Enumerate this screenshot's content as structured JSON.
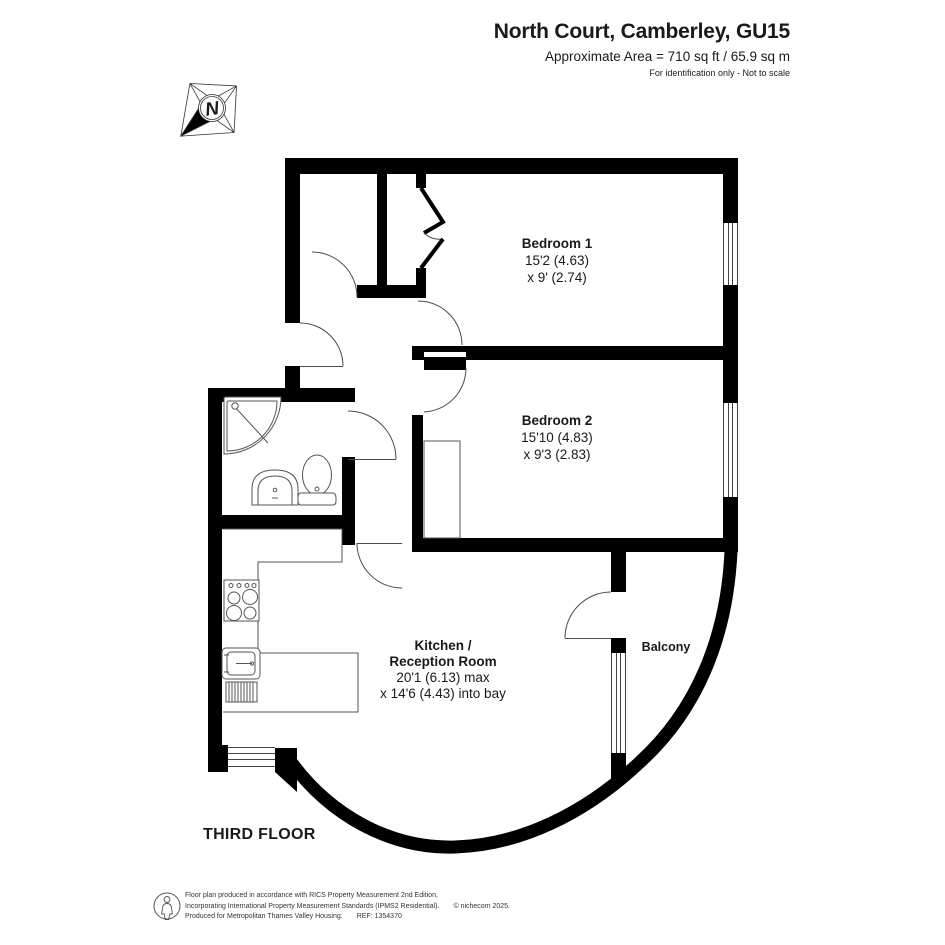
{
  "header": {
    "title": "North Court, Camberley, GU15",
    "area_line": "Approximate Area = 710 sq ft / 65.9 sq m",
    "note": "For identification only - Not to scale"
  },
  "floor_label": "THIRD FLOOR",
  "compass_label": "N",
  "rooms": {
    "bedroom1": {
      "name": "Bedroom 1",
      "dim_line1": "15'2 (4.63)",
      "dim_line2": "x 9' (2.74)"
    },
    "bedroom2": {
      "name": "Bedroom 2",
      "dim_line1": "15'10 (4.83)",
      "dim_line2": "x 9'3 (2.83)"
    },
    "kitchen": {
      "name_line1": "Kitchen /",
      "name_line2": "Reception Room",
      "dim_line1": "20'1 (6.13) max",
      "dim_line2": "x 14'6 (4.43) into bay"
    },
    "balcony": {
      "name": "Balcony"
    }
  },
  "footer": {
    "line1": "Floor plan produced in accordance with RICS Property Measurement 2nd Edition,",
    "line2": "Incorporating International Property Measurement Standards (IPMS2 Residential).",
    "copyright": "© nichecom 2025.",
    "line3": "Produced for Metropolitan Thames Valley Housing.",
    "ref": "REF: 1354370"
  },
  "colors": {
    "wall": "#000000",
    "thin_line": "#4a4a4a",
    "text": "#1a1a1a"
  }
}
